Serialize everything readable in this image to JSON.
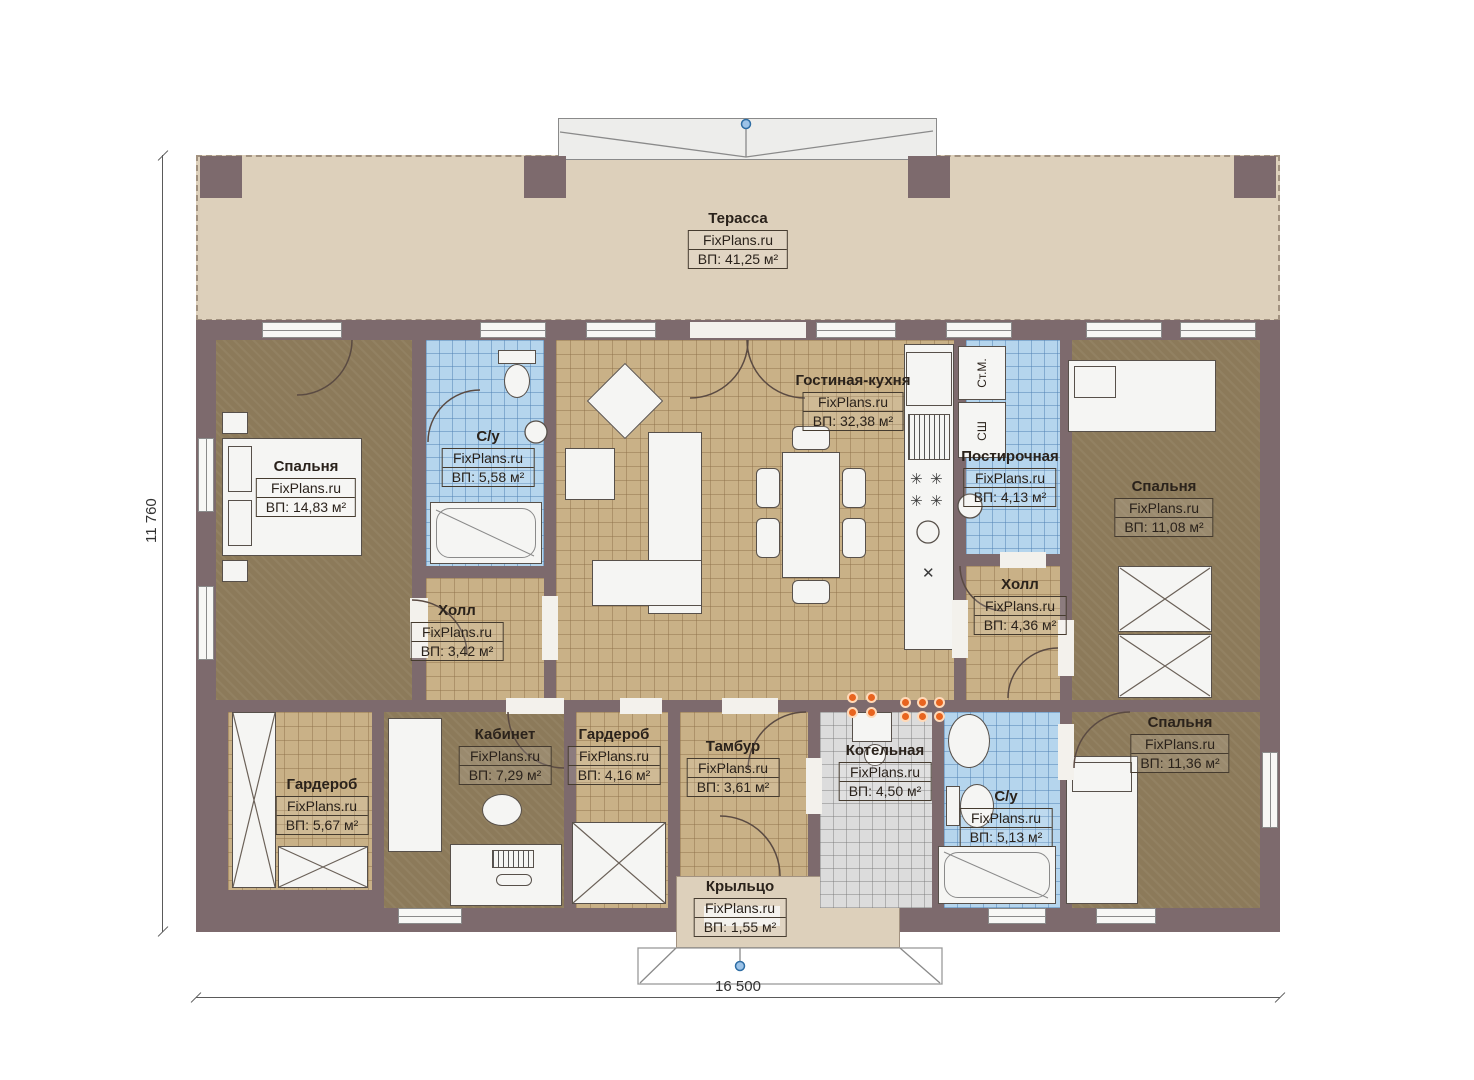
{
  "brand": "FixPlans.ru",
  "dimensions": {
    "width": "16 500",
    "height": "11 760"
  },
  "appliances": {
    "washer": "Ст.М.",
    "dryer": "СШ"
  },
  "rooms": {
    "terrace": {
      "name": "Терасса",
      "area": "ВП: 41,25 м²"
    },
    "bedroom_left": {
      "name": "Спальня",
      "area": "ВП: 14,83 м²"
    },
    "bathroom_top": {
      "name": "С/у",
      "area": "ВП: 5,58 м²"
    },
    "living_kitchen": {
      "name": "Гостиная-кухня",
      "area": "ВП: 32,38 м²"
    },
    "laundry": {
      "name": "Постирочная",
      "area": "ВП: 4,13 м²"
    },
    "bedroom_top_right": {
      "name": "Спальня",
      "area": "ВП: 11,08 м²"
    },
    "hall_left": {
      "name": "Холл",
      "area": "ВП: 3,42 м²"
    },
    "hall_right": {
      "name": "Холл",
      "area": "ВП: 4,36 м²"
    },
    "wardrobe_left": {
      "name": "Гардероб",
      "area": "ВП: 5,67 м²"
    },
    "office": {
      "name": "Кабинет",
      "area": "ВП: 7,29 м²"
    },
    "wardrobe_mid": {
      "name": "Гардероб",
      "area": "ВП: 4,16 м²"
    },
    "vestibule": {
      "name": "Тамбур",
      "area": "ВП: 3,61 м²"
    },
    "boiler": {
      "name": "Котельная",
      "area": "ВП: 4,50 м²"
    },
    "bathroom_bottom": {
      "name": "С/у",
      "area": "ВП: 5,13 м²"
    },
    "bedroom_bottom_right": {
      "name": "Спальня",
      "area": "ВП: 11,36 м²"
    },
    "porch": {
      "name": "Крыльцо",
      "area": "ВП: 1,55 м²"
    }
  },
  "colors": {
    "wall": "#7d6a6d",
    "terrace_floor": "#ddd0bb",
    "tile_tan": "#c9b187",
    "tile_blue": "#b5d5ed",
    "tile_gray": "#dcdcdc",
    "floor_brown": "#8c7a5a",
    "marker_orange": "#e8641f",
    "marker_blue": "#6ea3d8"
  }
}
